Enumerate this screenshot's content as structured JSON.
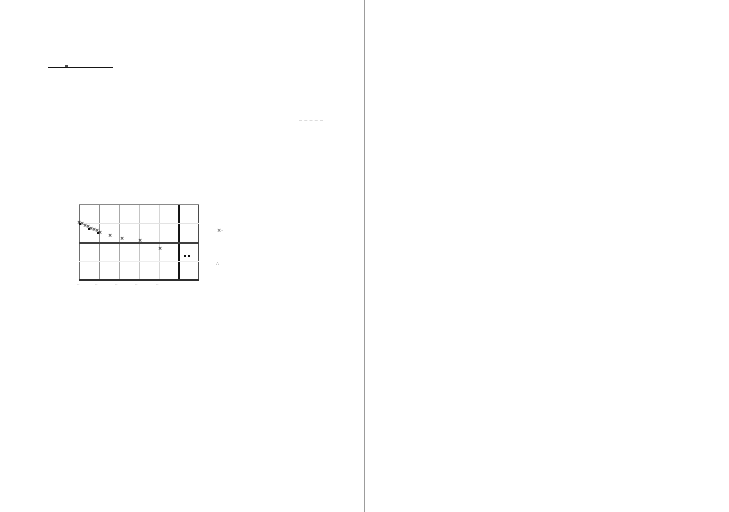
{
  "document": {
    "background": "#ffffff",
    "divider_color": "#9c9c9c",
    "page_count": 2,
    "title_rule_color": "#161616"
  },
  "chart_data": [
    {
      "id": "figure-1",
      "type": "scatter",
      "title": "",
      "xlabel": "",
      "ylabel": "",
      "grid": true,
      "legend_position": "right-outside",
      "box": {
        "left": 79,
        "top": 204,
        "width": 120,
        "height": 76
      },
      "vlines": [
        {
          "x": 0,
          "w": 1,
          "color": "#6e6e6e"
        },
        {
          "x": 20,
          "w": 1,
          "color": "#8f8f8f"
        },
        {
          "x": 40,
          "w": 1,
          "color": "#a8a8a8"
        },
        {
          "x": 60,
          "w": 1,
          "color": "#c4c4c4"
        },
        {
          "x": 80,
          "w": 1,
          "color": "#d6d6d6"
        },
        {
          "x": 99,
          "w": 2,
          "color": "#151515"
        },
        {
          "x": 119,
          "w": 1,
          "color": "#4a4a4a"
        }
      ],
      "hlines": [
        {
          "y": 0,
          "w": 1,
          "color": "#8a8a8a"
        },
        {
          "y": 19,
          "w": 1,
          "color": "#e3e3e3"
        },
        {
          "y": 38,
          "w": 2,
          "color": "#3f3f3f"
        },
        {
          "y": 57,
          "w": 1,
          "color": "#eeeeee"
        },
        {
          "y": 75,
          "w": 2,
          "color": "#2e2e2e"
        }
      ],
      "axis_line_units": {
        "x_axis_at_y_unit": 0,
        "thick_vline_at_x_unit": 5
      },
      "series": [
        {
          "name": "series-x-markers",
          "marker": "x",
          "color": "#1f1f1f",
          "points_px": [
            [
              0,
              20
            ],
            [
              3,
              21
            ],
            [
              6,
              23
            ],
            [
              9,
              24
            ],
            [
              12,
              26
            ],
            [
              15,
              27
            ],
            [
              18,
              28
            ],
            [
              21,
              30
            ],
            [
              31,
              33
            ],
            [
              43,
              36
            ],
            [
              61,
              38
            ],
            [
              81,
              46
            ]
          ],
          "values_est_units": [
            [
              0.0,
              0.95
            ],
            [
              0.15,
              0.89
            ],
            [
              0.3,
              0.79
            ],
            [
              0.45,
              0.74
            ],
            [
              0.6,
              0.63
            ],
            [
              0.75,
              0.58
            ],
            [
              0.9,
              0.53
            ],
            [
              1.05,
              0.47
            ],
            [
              1.55,
              0.32
            ],
            [
              2.15,
              0.16
            ],
            [
              3.05,
              0.0
            ],
            [
              4.05,
              -0.37
            ]
          ]
        },
        {
          "name": "series-square-markers",
          "marker": "square",
          "color": "#101010",
          "points_px": [
            [
              1,
              20,
              2
            ],
            [
              10,
              25,
              2
            ],
            [
              19,
              29,
              2
            ],
            [
              106,
              52,
              2
            ],
            [
              110,
              52,
              2
            ]
          ],
          "values_est_units": [
            [
              0.05,
              0.95
            ],
            [
              0.5,
              0.68
            ],
            [
              0.95,
              0.47
            ],
            [
              5.35,
              -0.74
            ],
            [
              5.55,
              -0.74
            ]
          ]
        }
      ],
      "x_ticks": [
        {
          "x": 0,
          "label": "··"
        },
        {
          "x": 18,
          "label": "··"
        },
        {
          "x": 38,
          "label": "··"
        },
        {
          "x": 58,
          "label": "··"
        },
        {
          "x": 79,
          "label": "··"
        }
      ],
      "legend": [
        {
          "glyph": "×·",
          "x": 138,
          "y": 25
        },
        {
          "glyph": "∴",
          "x": 137,
          "y": 58
        }
      ]
    },
    {
      "id": "figure-2",
      "type": "scatter",
      "title": "",
      "xlabel": "",
      "ylabel": "",
      "grid": true,
      "legend_position": "right-outside",
      "box": {
        "left": 439,
        "top": 221,
        "width": 122,
        "height": 76
      },
      "vlines": [
        {
          "x": 0,
          "w": 1,
          "color": "#9a9a9a"
        },
        {
          "x": 22,
          "w": 1,
          "color": "#c9c9c9"
        },
        {
          "x": 42,
          "w": 1,
          "color": "#cfcfcf"
        },
        {
          "x": 61,
          "w": 2,
          "color": "#101010"
        },
        {
          "x": 82,
          "w": 2,
          "color": "#101010"
        },
        {
          "x": 102,
          "w": 1,
          "color": "#d3d3d3"
        },
        {
          "x": 121,
          "w": 1,
          "color": "#8f8f8f"
        }
      ],
      "hlines": [
        {
          "y": 0,
          "w": 1,
          "color": "#b5b5b5"
        },
        {
          "y": 26,
          "w": 1,
          "color": "#c9c9c9"
        },
        {
          "y": 51,
          "w": 2,
          "color": "#585858"
        },
        {
          "y": 75,
          "w": 1,
          "color": "#8a8a8a"
        }
      ],
      "axis_line_units": {
        "x_axis_at_y_unit": 0,
        "thick_vlines_at_x_units": [
          3,
          4
        ]
      },
      "series": [
        {
          "name": "series-x-markers",
          "marker": "x",
          "color": "#1f1f1f",
          "points_px": [
            [
              -2,
              23
            ],
            [
              1,
              25
            ],
            [
              4,
              27
            ],
            [
              7,
              29
            ],
            [
              10,
              31
            ],
            [
              13,
              33
            ],
            [
              17,
              35
            ],
            [
              20,
              37
            ],
            [
              32,
              44
            ],
            [
              45,
              47
            ],
            [
              109,
              65
            ]
          ],
          "values_est_units": [
            [
              -0.1,
              1.12
            ],
            [
              0.05,
              1.04
            ],
            [
              0.2,
              0.96
            ],
            [
              0.34,
              0.88
            ],
            [
              0.49,
              0.8
            ],
            [
              0.64,
              0.72
            ],
            [
              0.84,
              0.64
            ],
            [
              0.98,
              0.56
            ],
            [
              1.57,
              0.28
            ],
            [
              2.21,
              0.16
            ],
            [
              5.36,
              -0.56
            ]
          ]
        },
        {
          "name": "series-square-markers",
          "marker": "square",
          "color": "#101010",
          "points_px": [
            [
              -1,
              23,
              2
            ],
            [
              8,
              29,
              2
            ],
            [
              18,
              36,
              2
            ],
            [
              61,
              51,
              4
            ],
            [
              85,
              57,
              2
            ],
            [
              85,
              60,
              2
            ]
          ],
          "values_est_units": [
            [
              -0.05,
              1.12
            ],
            [
              0.39,
              0.88
            ],
            [
              0.89,
              0.6
            ],
            [
              3.0,
              0.0
            ],
            [
              4.18,
              -0.24
            ],
            [
              4.18,
              -0.36
            ]
          ]
        }
      ],
      "x_ticks": [],
      "legend": [
        {
          "glyph": "×ʹ",
          "x": 140,
          "y": 28
        },
        {
          "glyph": "∴",
          "x": 138,
          "y": 60
        }
      ]
    }
  ]
}
